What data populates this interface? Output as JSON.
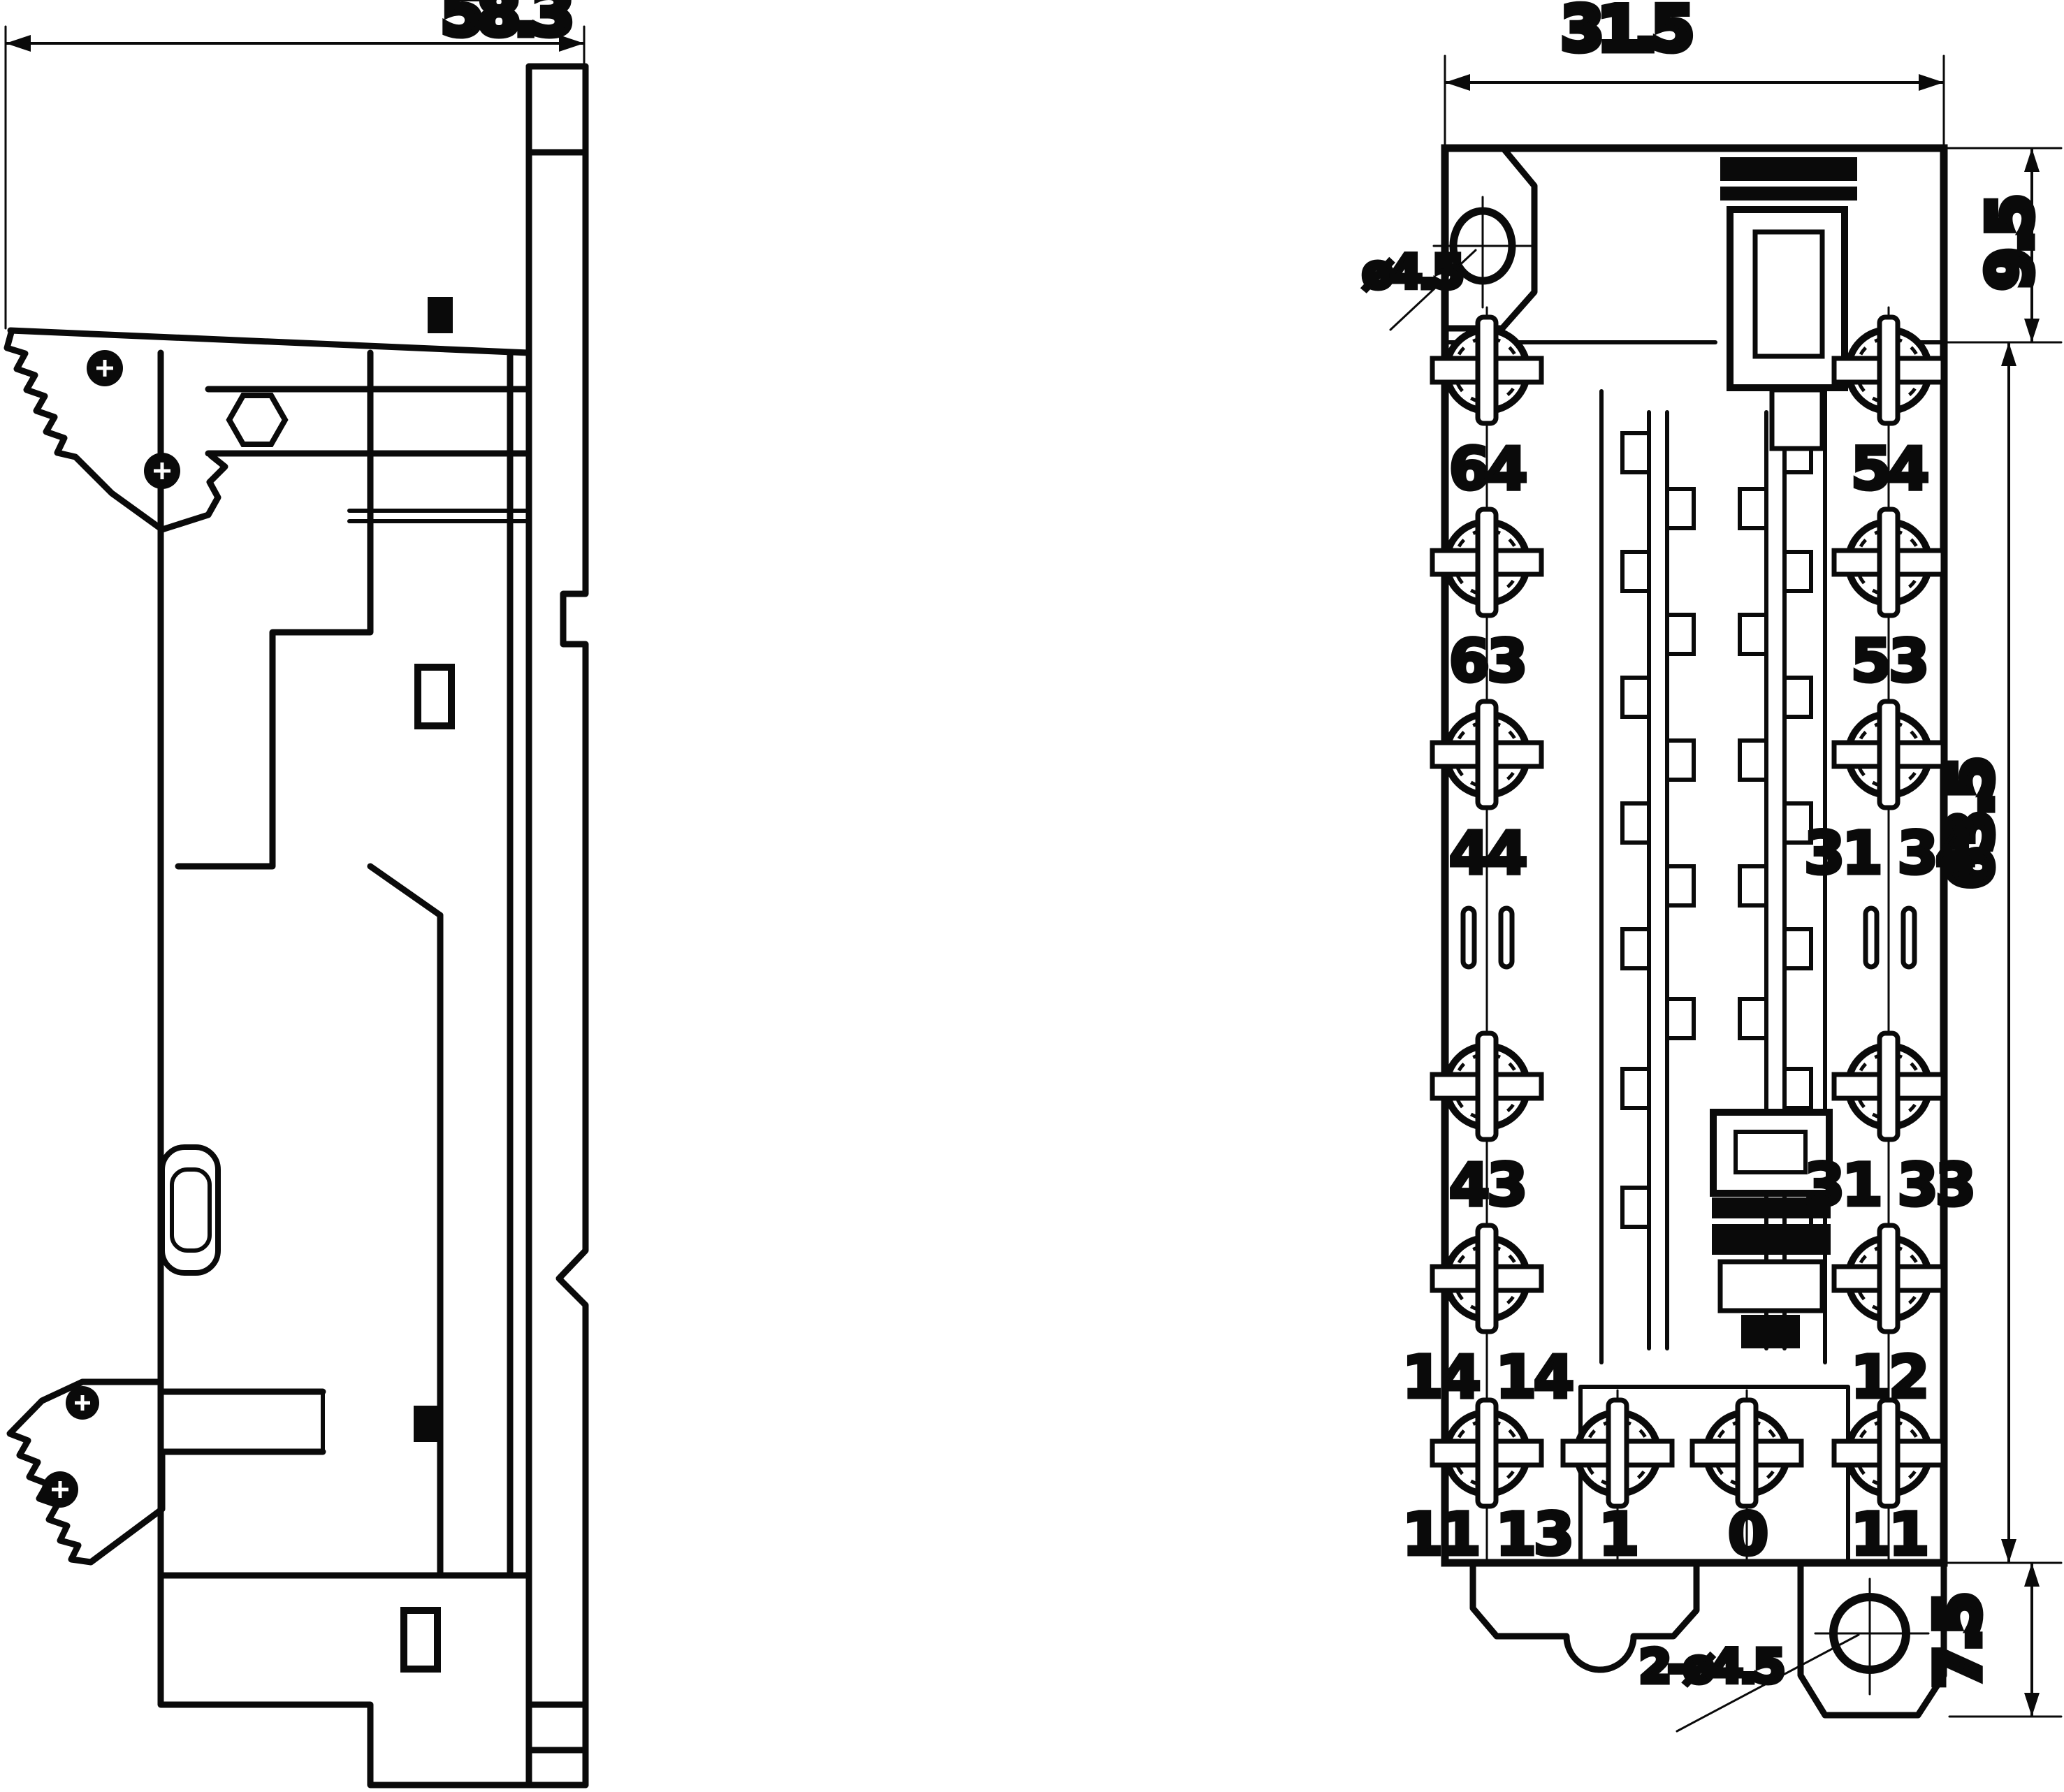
{
  "drawing": {
    "title": "relay-socket-dimensional-drawing",
    "line_color": "#0a0a0a",
    "background": "#ffffff"
  },
  "side_view": {
    "width_dim": "58.3"
  },
  "front_view": {
    "width_dim": "31.5",
    "top_section_dim": "9.5",
    "body_height_dim": "63.5",
    "mount_tab_dim": "7.5",
    "top_hole_note": "ø4.5",
    "bottom_hole_note": "2-ø4.5",
    "terminals": {
      "left": [
        "64",
        "63",
        "44",
        "43",
        "14 14",
        "11 13"
      ],
      "right": [
        "54",
        "53",
        "31 34",
        "31 33",
        "12",
        "11"
      ],
      "bottom": [
        "1",
        "0"
      ]
    }
  }
}
